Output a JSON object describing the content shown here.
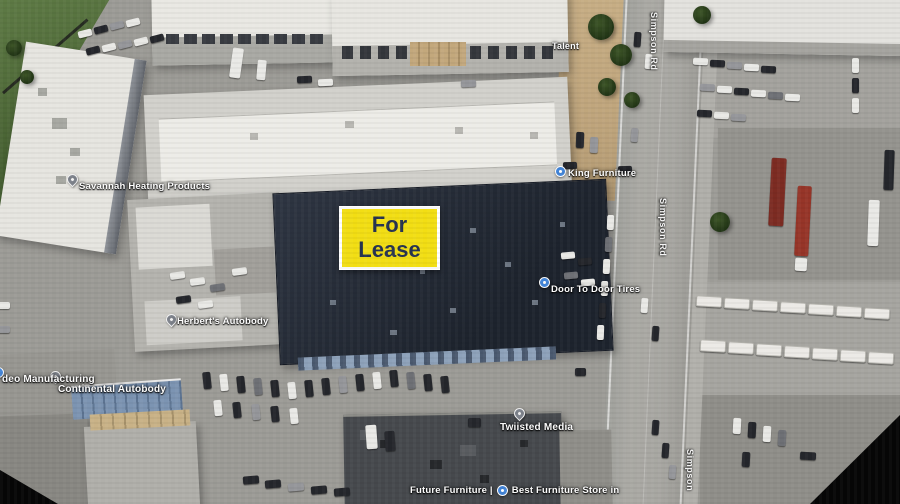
{
  "map": {
    "type": "aerial-satellite-imagery",
    "lease_sign": {
      "line1": "For",
      "line2": "Lease",
      "bg_color": "#f2de14",
      "text_color": "#273350",
      "border_color": "#ffffff"
    },
    "place_labels": {
      "savannah": "Savannah Heating Products",
      "herberts": "Herbert's Autobody",
      "manufacturing": "deo Manufacturing",
      "continental": "Continental Autobody",
      "twiisted": "Twiisted Media",
      "door_to_door": "Door To Door Tires",
      "king_furniture": "King Furniture",
      "future_furniture": "Future Furniture |",
      "best_furniture": "Best Furniture Store in",
      "talent": "Talent"
    },
    "road_labels": {
      "top": "Simpson Rd",
      "middle": "Simpson Rd",
      "bottom": "Simpson"
    },
    "icons": {
      "place_pin": "map-pin-icon",
      "poi_dot": "poi-dot-icon"
    }
  }
}
